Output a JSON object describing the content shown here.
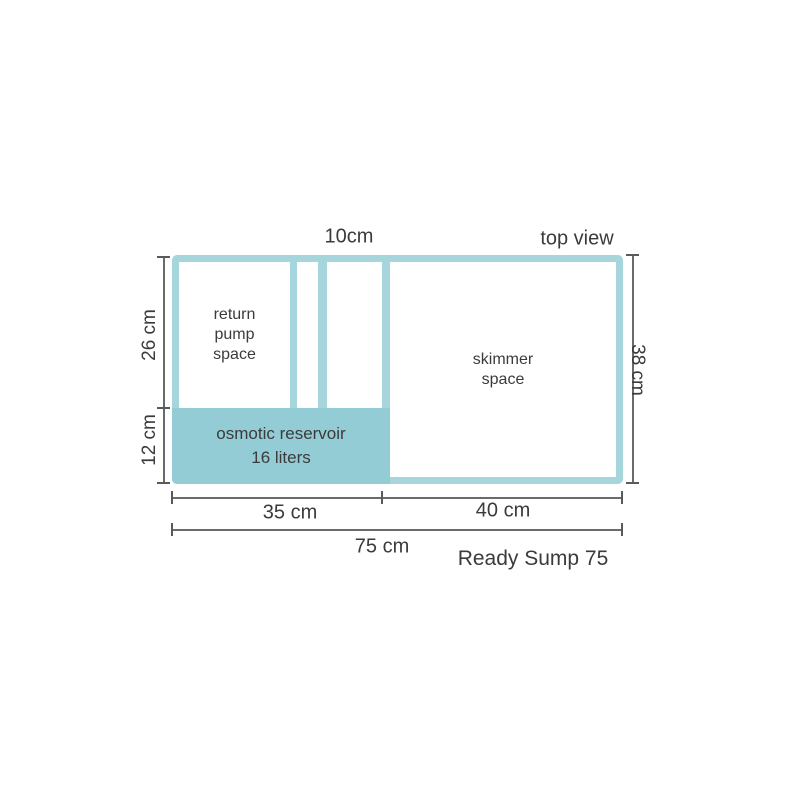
{
  "diagram": {
    "view_label": "top view",
    "product_name": "Ready Sump 75",
    "compartments": {
      "return_pump": {
        "line1": "return",
        "line2": "pump",
        "line3": "space"
      },
      "skimmer": {
        "line1": "skimmer",
        "line2": "space"
      },
      "osmotic_reservoir": {
        "line1": "osmotic reservoir",
        "line2": "16 liters"
      }
    },
    "dimensions": {
      "channel_width": "10cm",
      "return_section_depth": "26 cm",
      "reservoir_depth": "12 cm",
      "total_depth": "38 cm",
      "left_section_width": "35 cm",
      "skimmer_section_width": "40 cm",
      "total_width": "75 cm"
    },
    "colors": {
      "teal_border": "#a6d5db",
      "teal_fill": "#93ccd5",
      "dimension_line": "#6a6a6a",
      "text": "#3b3b3b",
      "background": "#ffffff"
    }
  }
}
